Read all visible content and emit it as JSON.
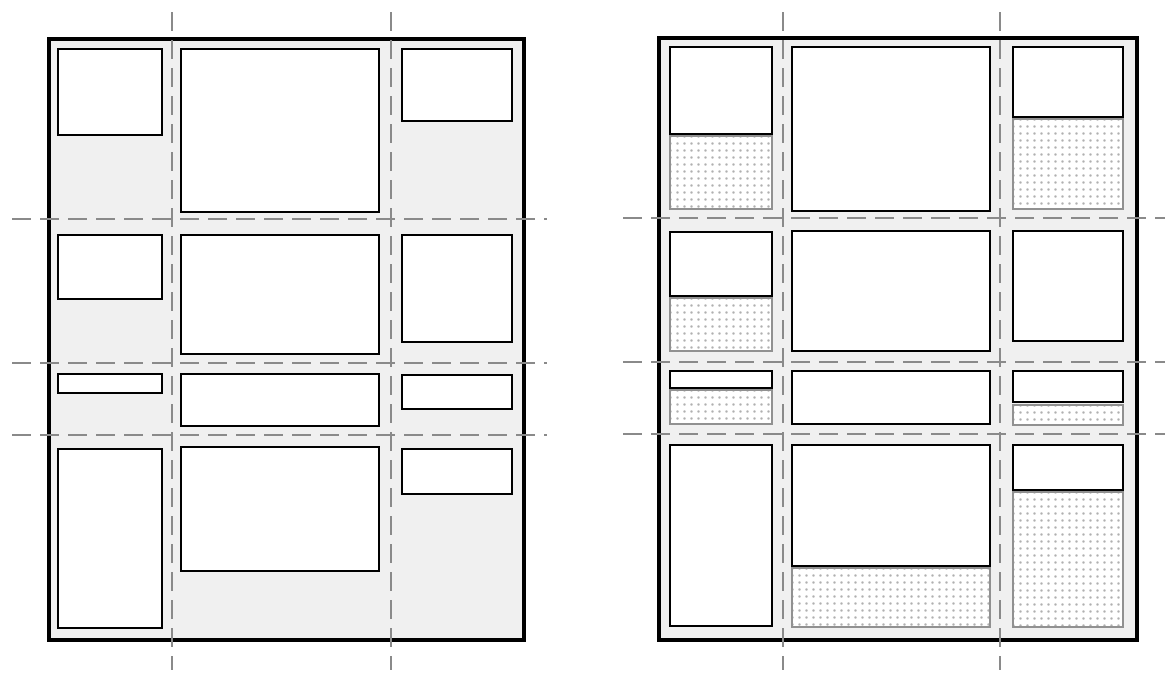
{
  "figure": {
    "kind": "grid-layout-comparison-diagram",
    "panels": 2,
    "text": ""
  },
  "colors": {
    "page_bg": "#ffffff",
    "container_bg": "#f0f0f0",
    "container_border": "#000000",
    "item_bg": "#ffffff",
    "item_border": "#000000",
    "leftover_border": "#919191",
    "leftover_dot": "#b0b0b0",
    "grid_line": "#8a8a8a"
  },
  "diagrams": [
    {
      "id": "left",
      "container": {
        "x": 47,
        "y": 37,
        "w": 479,
        "h": 605
      },
      "v_lines": {
        "xs": [
          171,
          390
        ],
        "y": 12,
        "length": 658
      },
      "h_lines": {
        "ys": [
          218,
          362,
          434
        ],
        "x": 12,
        "length": 535
      },
      "cells": [
        {
          "row": 1,
          "col": 1,
          "item": {
            "x": 57,
            "y": 48,
            "w": 106,
            "h": 88
          }
        },
        {
          "row": 1,
          "col": 2,
          "item": {
            "x": 180,
            "y": 48,
            "w": 200,
            "h": 165
          }
        },
        {
          "row": 1,
          "col": 3,
          "item": {
            "x": 401,
            "y": 48,
            "w": 112,
            "h": 74
          }
        },
        {
          "row": 2,
          "col": 1,
          "item": {
            "x": 57,
            "y": 234,
            "w": 106,
            "h": 66
          }
        },
        {
          "row": 2,
          "col": 2,
          "item": {
            "x": 180,
            "y": 234,
            "w": 200,
            "h": 121
          }
        },
        {
          "row": 2,
          "col": 3,
          "item": {
            "x": 401,
            "y": 234,
            "w": 112,
            "h": 109
          }
        },
        {
          "row": 3,
          "col": 1,
          "item": {
            "x": 57,
            "y": 373,
            "w": 106,
            "h": 21
          }
        },
        {
          "row": 3,
          "col": 2,
          "item": {
            "x": 180,
            "y": 373,
            "w": 200,
            "h": 54
          }
        },
        {
          "row": 3,
          "col": 3,
          "item": {
            "x": 401,
            "y": 374,
            "w": 112,
            "h": 36
          }
        },
        {
          "row": 4,
          "col": 1,
          "item": {
            "x": 57,
            "y": 448,
            "w": 106,
            "h": 181
          }
        },
        {
          "row": 4,
          "col": 2,
          "item": {
            "x": 180,
            "y": 446,
            "w": 200,
            "h": 126
          }
        },
        {
          "row": 4,
          "col": 3,
          "item": {
            "x": 401,
            "y": 448,
            "w": 112,
            "h": 47
          }
        }
      ]
    },
    {
      "id": "right",
      "container": {
        "x": 657,
        "y": 36,
        "w": 482,
        "h": 606
      },
      "v_lines": {
        "xs": [
          782,
          999
        ],
        "y": 12,
        "length": 658
      },
      "h_lines": {
        "ys": [
          217,
          361,
          433
        ],
        "x": 623,
        "length": 542
      },
      "cells": [
        {
          "row": 1,
          "col": 1,
          "item": {
            "x": 669,
            "y": 46,
            "w": 104,
            "h": 89
          },
          "leftover": {
            "x": 669,
            "y": 135,
            "w": 104,
            "h": 75
          }
        },
        {
          "row": 1,
          "col": 2,
          "item": {
            "x": 791,
            "y": 46,
            "w": 200,
            "h": 166
          }
        },
        {
          "row": 1,
          "col": 3,
          "item": {
            "x": 1012,
            "y": 46,
            "w": 112,
            "h": 72
          },
          "leftover": {
            "x": 1012,
            "y": 118,
            "w": 112,
            "h": 92
          }
        },
        {
          "row": 2,
          "col": 1,
          "item": {
            "x": 669,
            "y": 231,
            "w": 104,
            "h": 66
          },
          "leftover": {
            "x": 669,
            "y": 297,
            "w": 104,
            "h": 55
          }
        },
        {
          "row": 2,
          "col": 2,
          "item": {
            "x": 791,
            "y": 230,
            "w": 200,
            "h": 122
          }
        },
        {
          "row": 2,
          "col": 3,
          "item": {
            "x": 1012,
            "y": 230,
            "w": 112,
            "h": 112
          }
        },
        {
          "row": 3,
          "col": 1,
          "item": {
            "x": 669,
            "y": 370,
            "w": 104,
            "h": 19
          },
          "leftover": {
            "x": 669,
            "y": 389,
            "w": 104,
            "h": 36
          }
        },
        {
          "row": 3,
          "col": 2,
          "item": {
            "x": 791,
            "y": 370,
            "w": 200,
            "h": 55
          }
        },
        {
          "row": 3,
          "col": 3,
          "item": {
            "x": 1012,
            "y": 370,
            "w": 112,
            "h": 33
          },
          "leftover": {
            "x": 1012,
            "y": 404,
            "w": 112,
            "h": 22
          }
        },
        {
          "row": 4,
          "col": 1,
          "item": {
            "x": 669,
            "y": 444,
            "w": 104,
            "h": 183
          }
        },
        {
          "row": 4,
          "col": 2,
          "item": {
            "x": 791,
            "y": 444,
            "w": 200,
            "h": 123
          },
          "leftover": {
            "x": 791,
            "y": 567,
            "w": 200,
            "h": 61
          }
        },
        {
          "row": 4,
          "col": 3,
          "item": {
            "x": 1012,
            "y": 444,
            "w": 112,
            "h": 47
          },
          "leftover": {
            "x": 1012,
            "y": 491,
            "w": 112,
            "h": 137
          }
        }
      ]
    }
  ]
}
